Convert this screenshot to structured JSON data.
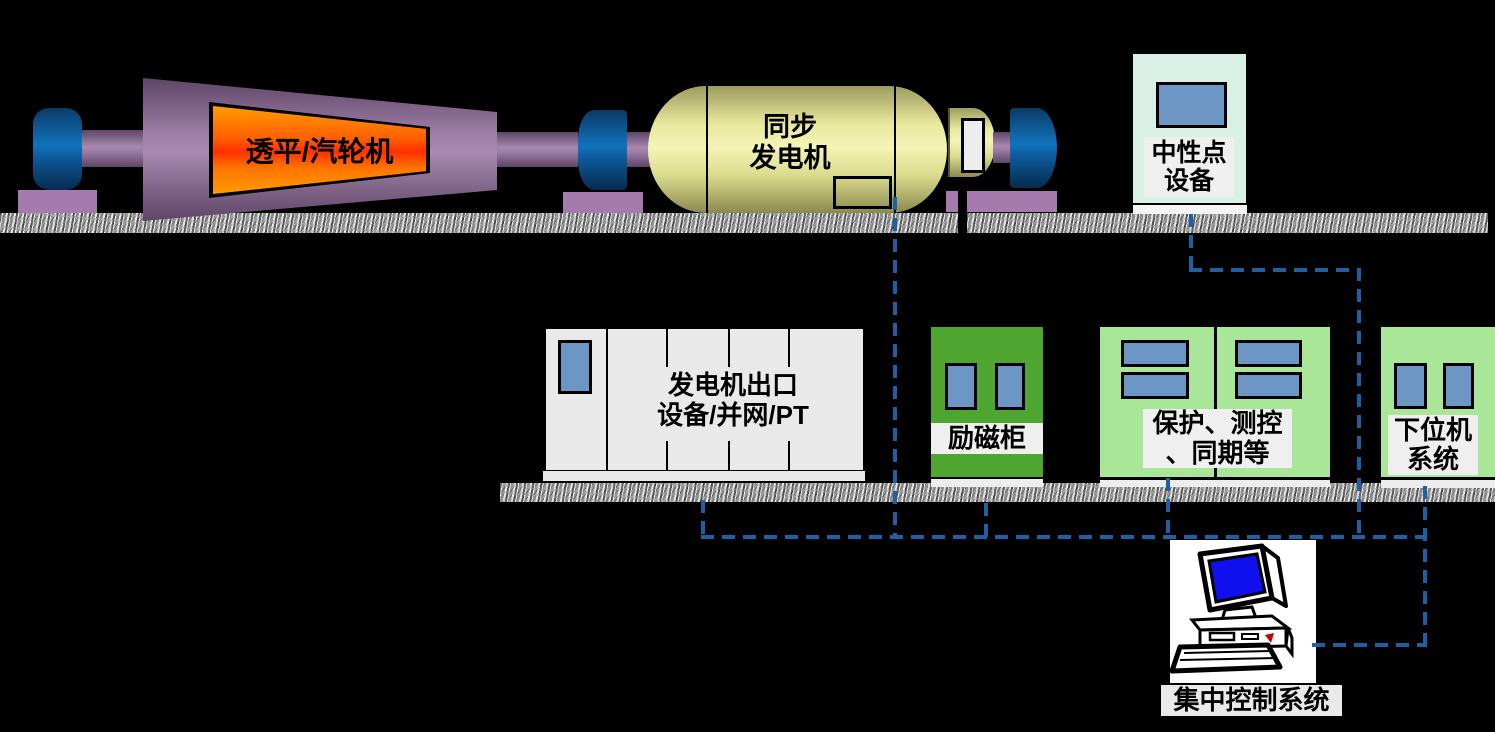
{
  "colors": {
    "background": "#000000",
    "dashed_line": "#1f5fa3",
    "turbine_purple": "#9a79a3",
    "turbine_core_orange_top": "#ff9c00",
    "turbine_core_orange_mid": "#ff3000",
    "bearing_blue": "#1173bc",
    "generator_yellow": "#f4f4b6",
    "excitation_green": "#4ea52f",
    "cabinet_light_green": "#a9e698",
    "neutral_point_mint": "#d9f0e6",
    "panel_blue": "#6c96c3",
    "outlet_cabinet_gray": "#e9e9e9",
    "label_band_gray": "#efefef",
    "pc_screen_blue": "#1010ee"
  },
  "labels": {
    "turbine": "透平/汽轮机",
    "generator_line1": "同步",
    "generator_line2": "发电机",
    "neutral_line1": "中性点",
    "neutral_line2": "设备",
    "outlet_line1": "发电机出口",
    "outlet_line2": "设备/并网/PT",
    "excitation": "励磁柜",
    "protection_line1": "保护、测控",
    "protection_line2": "、同期等",
    "lower_computer_line1": "下位机",
    "lower_computer_line2": "系统",
    "central_control": "集中控制系统"
  }
}
